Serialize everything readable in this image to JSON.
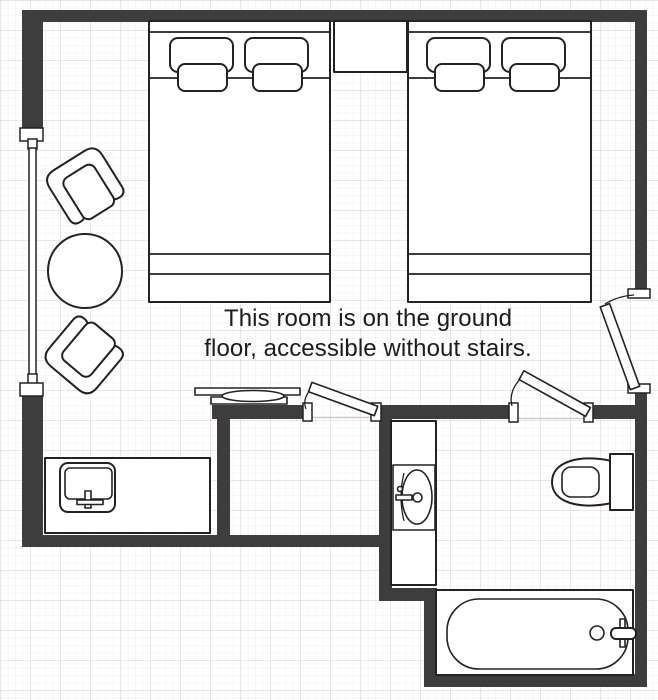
{
  "floor_plan": {
    "caption": {
      "line1": "This room is on the ground",
      "line2": "floor, accessible without stairs."
    },
    "colors": {
      "wall": "#3d3d3d",
      "outline": "#222222",
      "fixture-fill": "#ffffff",
      "text": "#1c1c1c",
      "background": "#ffffff",
      "grid-minor": "rgba(205,180,180,0.12)",
      "grid-major": "rgba(195,165,165,0.20)"
    },
    "rooms": [
      {
        "name": "bedroom",
        "fixtures": [
          "window",
          "armchair-top",
          "round-table",
          "armchair-bottom",
          "twin-bed-left",
          "nightstand",
          "twin-bed-right",
          "tv-console",
          "desk-sink-unit",
          "entrance-door"
        ]
      },
      {
        "name": "closet",
        "fixtures": [
          "closet-door"
        ]
      },
      {
        "name": "bathroom",
        "fixtures": [
          "bathroom-door",
          "vanity-counter",
          "bathroom-sink",
          "toilet",
          "bathtub"
        ]
      }
    ]
  }
}
